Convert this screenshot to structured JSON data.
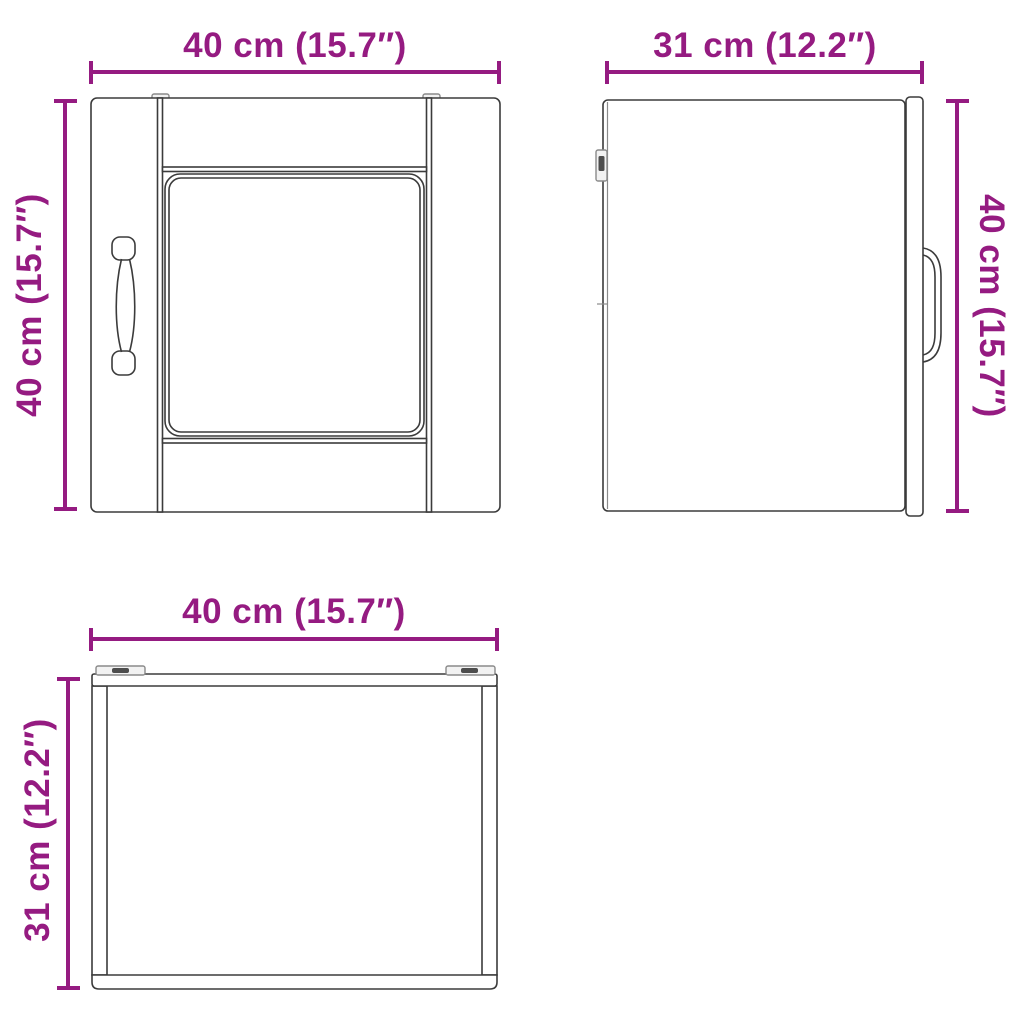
{
  "colors": {
    "dimension": "#951b81",
    "outline": "#3b3b3b",
    "detail_gray": "#8a8a8a",
    "detail_dark": "#4d4d4d",
    "background": "#ffffff"
  },
  "views": {
    "front": {
      "width_label": "40 cm (15.7″)",
      "height_label": "40 cm (15.7″)",
      "width_cm": 40,
      "width_in": 15.7,
      "height_cm": 40,
      "height_in": 15.7
    },
    "side": {
      "width_label": "31 cm (12.2″)",
      "height_label": "40 cm (15.7″)",
      "width_cm": 31,
      "width_in": 12.2,
      "height_cm": 40,
      "height_in": 15.7
    },
    "top": {
      "width_label": "40 cm (15.7″)",
      "depth_label": "31 cm (12.2″)",
      "width_cm": 40,
      "width_in": 15.7,
      "depth_cm": 31,
      "depth_in": 12.2
    }
  }
}
